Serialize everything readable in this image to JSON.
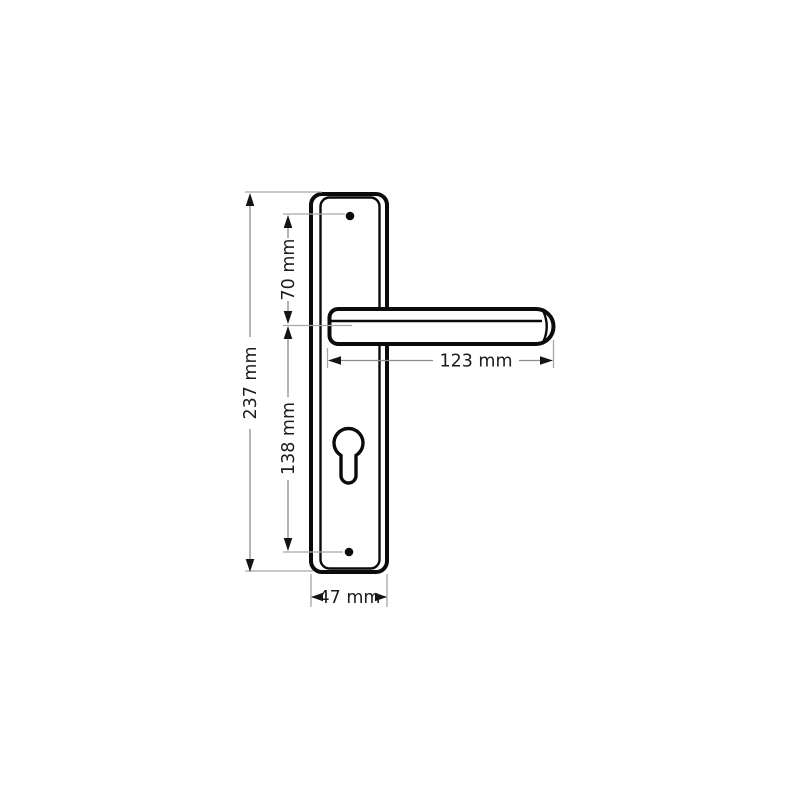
{
  "title": "Dimensioned technical drawing of a lever door handle on a backplate",
  "unit": "mm",
  "colors": {
    "background": "#ffffff",
    "outline": "#0b0b0b",
    "dimension": "#8c8c8c",
    "extension": "#a6a6a6",
    "arrow": "#141414",
    "text": "#1c1c1c"
  },
  "parts": {
    "backplate": "backplate",
    "lever": "lever-handle",
    "keyhole": "euro-cylinder-keyhole",
    "screw_top": "screw-hole-top",
    "screw_bottom": "screw-hole-bottom"
  },
  "dimensions": {
    "plate_height": {
      "value": 237,
      "label": "237 mm"
    },
    "top_hole_to_handle": {
      "value": 70,
      "label": "70 mm"
    },
    "handle_to_bottom_hole": {
      "value": 138,
      "label": "138 mm"
    },
    "handle_length": {
      "value": 123,
      "label": "123 mm"
    },
    "plate_width": {
      "value": 47,
      "label": "47 mm"
    }
  }
}
